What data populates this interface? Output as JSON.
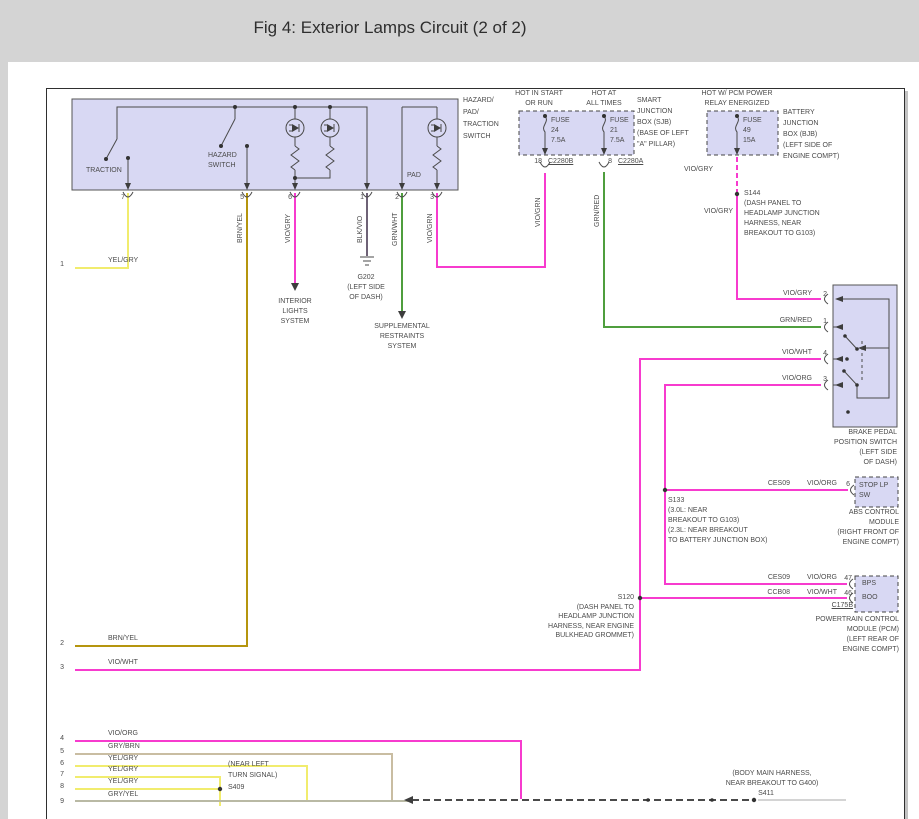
{
  "title": "Fig 4: Exterior Lamps Circuit (2 of 2)",
  "colors": {
    "violet_wire": "#f73bce",
    "green_wire": "#4f9e3e",
    "yellow_wire": "#f1ec6e",
    "brown_yellow_wire": "#b5950e",
    "tan_wire": "#c9bda2",
    "grey_yellow_wire": "#b9b9a4",
    "black_violet_wire": "#6e6276",
    "diagram_ink": "#4a4a4a",
    "component_fill": "#d8d8f3",
    "chrome_grey": "#d4d4d4",
    "panel_white": "#ffffff"
  },
  "diagram": {
    "labels": [
      {
        "n": "switch-traction-label",
        "t": "TRACTION",
        "x": 86,
        "y": 167
      },
      {
        "n": "switch-hazard-label-1",
        "t": "HAZARD",
        "x": 208,
        "y": 152
      },
      {
        "n": "switch-hazard-label-2",
        "t": "SWITCH",
        "x": 208,
        "y": 162
      },
      {
        "n": "switch-pad-label",
        "t": "PAD",
        "x": 407,
        "y": 172
      },
      {
        "n": "switch-name-1",
        "t": "HAZARD/",
        "x": 463,
        "y": 97
      },
      {
        "n": "switch-name-2",
        "t": "PAD/",
        "x": 463,
        "y": 109
      },
      {
        "n": "switch-name-3",
        "t": "TRACTION",
        "x": 463,
        "y": 121
      },
      {
        "n": "switch-name-4",
        "t": "SWITCH",
        "x": 463,
        "y": 133
      },
      {
        "n": "switch-pin-7",
        "t": "7",
        "x": 125,
        "y": 194,
        "a": "r"
      },
      {
        "n": "switch-pin-5",
        "t": "5",
        "x": 244,
        "y": 194,
        "a": "r"
      },
      {
        "n": "switch-pin-6",
        "t": "6",
        "x": 292,
        "y": 194,
        "a": "r"
      },
      {
        "n": "switch-pin-1",
        "t": "1",
        "x": 364,
        "y": 194,
        "a": "r"
      },
      {
        "n": "switch-pin-2",
        "t": "2",
        "x": 399,
        "y": 194,
        "a": "r"
      },
      {
        "n": "switch-pin-3",
        "t": "3",
        "x": 434,
        "y": 194,
        "a": "r"
      },
      {
        "n": "wire-brnyel-vert",
        "t": "BRN/YEL",
        "x": 237,
        "y": 243,
        "r": 1
      },
      {
        "n": "wire-viogry-vert",
        "t": "VIO/GRY",
        "x": 285,
        "y": 243,
        "r": 1
      },
      {
        "n": "wire-blkvio-vert",
        "t": "BLK/VIO",
        "x": 357,
        "y": 243,
        "r": 1
      },
      {
        "n": "wire-grnwht-vert",
        "t": "GRN/WHT",
        "x": 392,
        "y": 246,
        "r": 1
      },
      {
        "n": "wire-viogrn-vert-1",
        "t": "VIO/GRN",
        "x": 427,
        "y": 243,
        "r": 1
      },
      {
        "n": "wire-viogrn-vert-2",
        "t": "VIO/GRN",
        "x": 535,
        "y": 227,
        "r": 1
      },
      {
        "n": "wire-grnred-vert",
        "t": "GRN/RED",
        "x": 594,
        "y": 227,
        "r": 1
      },
      {
        "n": "power-label-1a",
        "t": "HOT IN START",
        "x": 539,
        "y": 90,
        "a": "c"
      },
      {
        "n": "power-label-1b",
        "t": "OR RUN",
        "x": 539,
        "y": 100,
        "a": "c"
      },
      {
        "n": "power-label-2a",
        "t": "HOT AT",
        "x": 604,
        "y": 90,
        "a": "c"
      },
      {
        "n": "power-label-2b",
        "t": "ALL TIMES",
        "x": 604,
        "y": 100,
        "a": "c"
      },
      {
        "n": "power-label-3a",
        "t": "HOT W/ PCM POWER",
        "x": 737,
        "y": 90,
        "a": "c"
      },
      {
        "n": "power-label-3b",
        "t": "RELAY ENERGIZED",
        "x": 737,
        "y": 100,
        "a": "c"
      },
      {
        "n": "fuse24-line1",
        "t": "FUSE",
        "x": 551,
        "y": 117
      },
      {
        "n": "fuse24-line2",
        "t": "24",
        "x": 551,
        "y": 127
      },
      {
        "n": "fuse24-line3",
        "t": "7.5A",
        "x": 551,
        "y": 137
      },
      {
        "n": "fuse21-line1",
        "t": "FUSE",
        "x": 610,
        "y": 117
      },
      {
        "n": "fuse21-line2",
        "t": "21",
        "x": 610,
        "y": 127
      },
      {
        "n": "fuse21-line3",
        "t": "7.5A",
        "x": 610,
        "y": 137
      },
      {
        "n": "fuse49-line1",
        "t": "FUSE",
        "x": 743,
        "y": 117
      },
      {
        "n": "fuse49-line2",
        "t": "49",
        "x": 743,
        "y": 127
      },
      {
        "n": "fuse49-line3",
        "t": "15A",
        "x": 743,
        "y": 137
      },
      {
        "n": "sjb-name-1",
        "t": "SMART",
        "x": 637,
        "y": 97
      },
      {
        "n": "sjb-name-2",
        "t": "JUNCTION",
        "x": 637,
        "y": 108
      },
      {
        "n": "sjb-name-3",
        "t": "BOX (SJB)",
        "x": 637,
        "y": 119
      },
      {
        "n": "sjb-name-4",
        "t": "(BASE OF LEFT",
        "x": 637,
        "y": 130
      },
      {
        "n": "sjb-name-5",
        "t": "\"A\" PILLAR)",
        "x": 637,
        "y": 141
      },
      {
        "n": "bjb-name-1",
        "t": "BATTERY",
        "x": 783,
        "y": 109
      },
      {
        "n": "bjb-name-2",
        "t": "JUNCTION",
        "x": 783,
        "y": 120
      },
      {
        "n": "bjb-name-3",
        "t": "BOX (BJB)",
        "x": 783,
        "y": 131
      },
      {
        "n": "bjb-name-4",
        "t": "(LEFT SIDE OF",
        "x": 783,
        "y": 142
      },
      {
        "n": "bjb-name-5",
        "t": "ENGINE COMPT)",
        "x": 783,
        "y": 153
      },
      {
        "n": "conn-pin-18",
        "t": "18",
        "x": 542,
        "y": 158,
        "a": "r"
      },
      {
        "n": "conn-c2280b",
        "t": "C2280B",
        "x": 548,
        "y": 158,
        "u": 1
      },
      {
        "n": "conn-pin-8",
        "t": "8",
        "x": 612,
        "y": 158,
        "a": "r"
      },
      {
        "n": "conn-c2280a",
        "t": "C2280A",
        "x": 618,
        "y": 158,
        "u": 1
      },
      {
        "n": "wire-viogry-bjb",
        "t": "VIO/GRY",
        "x": 684,
        "y": 166
      },
      {
        "n": "s144-label",
        "t": "S144",
        "x": 744,
        "y": 190
      },
      {
        "n": "s144-note-1",
        "t": "(DASH PANEL TO",
        "x": 744,
        "y": 200
      },
      {
        "n": "s144-note-2",
        "t": "HEADLAMP JUNCTION",
        "x": 744,
        "y": 210
      },
      {
        "n": "s144-note-3",
        "t": "HARNESS, NEAR",
        "x": 744,
        "y": 220
      },
      {
        "n": "s144-note-4",
        "t": "BREAKOUT TO G103)",
        "x": 744,
        "y": 230
      },
      {
        "n": "wire-viogry-2",
        "t": "VIO/GRY",
        "x": 704,
        "y": 208
      },
      {
        "n": "bps-pin2-color",
        "t": "VIO/GRY",
        "x": 812,
        "y": 290,
        "a": "r"
      },
      {
        "n": "bps-pin2-num",
        "t": "2",
        "x": 827,
        "y": 291,
        "a": "r"
      },
      {
        "n": "bps-pin1-color",
        "t": "GRN/RED",
        "x": 812,
        "y": 317,
        "a": "r"
      },
      {
        "n": "bps-pin1-num",
        "t": "1",
        "x": 827,
        "y": 318,
        "a": "r"
      },
      {
        "n": "bps-pin4-color",
        "t": "VIO/WHT",
        "x": 812,
        "y": 349,
        "a": "r"
      },
      {
        "n": "bps-pin4-num",
        "t": "4",
        "x": 827,
        "y": 350,
        "a": "r"
      },
      {
        "n": "bps-pin3-color",
        "t": "VIO/ORG",
        "x": 812,
        "y": 375,
        "a": "r"
      },
      {
        "n": "bps-pin3-num",
        "t": "3",
        "x": 827,
        "y": 376,
        "a": "r"
      },
      {
        "n": "bps-name-1",
        "t": "BRAKE PEDAL",
        "x": 897,
        "y": 429,
        "a": "r"
      },
      {
        "n": "bps-name-2",
        "t": "POSITION SWITCH",
        "x": 897,
        "y": 439,
        "a": "r"
      },
      {
        "n": "bps-name-3",
        "t": "(LEFT SIDE",
        "x": 897,
        "y": 449,
        "a": "r"
      },
      {
        "n": "bps-name-4",
        "t": "OF DASH)",
        "x": 897,
        "y": 459,
        "a": "r"
      },
      {
        "n": "abs-circuit-id",
        "t": "CES09",
        "x": 790,
        "y": 480,
        "a": "r"
      },
      {
        "n": "abs-wire-color",
        "t": "VIO/ORG",
        "x": 837,
        "y": 480,
        "a": "r"
      },
      {
        "n": "abs-pin6-num",
        "t": "6",
        "x": 850,
        "y": 481,
        "a": "r"
      },
      {
        "n": "stoplp-label-1",
        "t": "STOP LP",
        "x": 859,
        "y": 482
      },
      {
        "n": "stoplp-label-2",
        "t": "SW",
        "x": 859,
        "y": 492
      },
      {
        "n": "abs-name-1",
        "t": "ABS CONTROL",
        "x": 899,
        "y": 509,
        "a": "r"
      },
      {
        "n": "abs-name-2",
        "t": "MODULE",
        "x": 899,
        "y": 519,
        "a": "r"
      },
      {
        "n": "abs-name-3",
        "t": "(RIGHT FRONT OF",
        "x": 899,
        "y": 529,
        "a": "r"
      },
      {
        "n": "abs-name-4",
        "t": "ENGINE COMPT)",
        "x": 899,
        "y": 539,
        "a": "r"
      },
      {
        "n": "s133-label",
        "t": "S133",
        "x": 668,
        "y": 497
      },
      {
        "n": "s133-note-1",
        "t": "(3.0L: NEAR",
        "x": 668,
        "y": 507
      },
      {
        "n": "s133-note-2",
        "t": "BREAKOUT TO G103)",
        "x": 668,
        "y": 517
      },
      {
        "n": "s133-note-3",
        "t": "(2.3L: NEAR BREAKOUT",
        "x": 668,
        "y": 527
      },
      {
        "n": "s133-note-4",
        "t": "TO BATTERY JUNCTION BOX)",
        "x": 668,
        "y": 537
      },
      {
        "n": "pcm-row1-circuit",
        "t": "CES09",
        "x": 790,
        "y": 574,
        "a": "r"
      },
      {
        "n": "pcm-row1-color",
        "t": "VIO/ORG",
        "x": 837,
        "y": 574,
        "a": "r"
      },
      {
        "n": "pcm-pin47-num",
        "t": "47",
        "x": 852,
        "y": 575,
        "a": "r"
      },
      {
        "n": "pcm-row2-circuit",
        "t": "CCB08",
        "x": 790,
        "y": 589,
        "a": "r"
      },
      {
        "n": "pcm-row2-color",
        "t": "VIO/WHT",
        "x": 837,
        "y": 589,
        "a": "r"
      },
      {
        "n": "pcm-pin46-num",
        "t": "46",
        "x": 852,
        "y": 590,
        "a": "r"
      },
      {
        "n": "pcm-bps-label",
        "t": "BPS",
        "x": 862,
        "y": 580
      },
      {
        "n": "pcm-boo-label",
        "t": "BOO",
        "x": 862,
        "y": 594
      },
      {
        "n": "pcm-c175b",
        "t": "C175B",
        "x": 853,
        "y": 602,
        "a": "r",
        "u": 1
      },
      {
        "n": "pcm-name-1",
        "t": "POWERTRAIN CONTROL",
        "x": 899,
        "y": 616,
        "a": "r"
      },
      {
        "n": "pcm-name-2",
        "t": "MODULE (PCM)",
        "x": 899,
        "y": 626,
        "a": "r"
      },
      {
        "n": "pcm-name-3",
        "t": "(LEFT REAR OF",
        "x": 899,
        "y": 636,
        "a": "r"
      },
      {
        "n": "pcm-name-4",
        "t": "ENGINE COMPT)",
        "x": 899,
        "y": 646,
        "a": "r"
      },
      {
        "n": "s120-label",
        "t": "S120",
        "x": 634,
        "y": 594,
        "a": "r"
      },
      {
        "n": "s120-note-1",
        "t": "(DASH PANEL TO",
        "x": 634,
        "y": 604,
        "a": "r"
      },
      {
        "n": "s120-note-2",
        "t": "HEADLAMP JUNCTION",
        "x": 634,
        "y": 613,
        "a": "r"
      },
      {
        "n": "s120-note-3",
        "t": "HARNESS, NEAR ENGINE",
        "x": 634,
        "y": 623,
        "a": "r"
      },
      {
        "n": "s120-note-4",
        "t": "BULKHEAD GROMMET)",
        "x": 634,
        "y": 632,
        "a": "r"
      },
      {
        "n": "interior-lights-1",
        "t": "INTERIOR",
        "x": 295,
        "y": 298,
        "a": "c"
      },
      {
        "n": "interior-lights-2",
        "t": "LIGHTS",
        "x": 295,
        "y": 308,
        "a": "c"
      },
      {
        "n": "interior-lights-3",
        "t": "SYSTEM",
        "x": 295,
        "y": 318,
        "a": "c"
      },
      {
        "n": "g202-label",
        "t": "G202",
        "x": 366,
        "y": 274,
        "a": "c"
      },
      {
        "n": "g202-note-1",
        "t": "(LEFT SIDE",
        "x": 366,
        "y": 284,
        "a": "c"
      },
      {
        "n": "g202-note-2",
        "t": "OF DASH)",
        "x": 366,
        "y": 294,
        "a": "c"
      },
      {
        "n": "srs-label-1",
        "t": "SUPPLEMENTAL",
        "x": 402,
        "y": 323,
        "a": "c"
      },
      {
        "n": "srs-label-2",
        "t": "RESTRAINTS",
        "x": 402,
        "y": 333,
        "a": "c"
      },
      {
        "n": "srs-label-3",
        "t": "SYSTEM",
        "x": 402,
        "y": 343,
        "a": "c"
      },
      {
        "n": "wire1-num",
        "t": "1",
        "x": 64,
        "y": 261,
        "a": "r"
      },
      {
        "n": "wire1-color",
        "t": "YEL/GRY",
        "x": 108,
        "y": 257
      },
      {
        "n": "wire2-num",
        "t": "2",
        "x": 64,
        "y": 640,
        "a": "r"
      },
      {
        "n": "wire2-color",
        "t": "BRN/YEL",
        "x": 108,
        "y": 635
      },
      {
        "n": "wire3-num",
        "t": "3",
        "x": 64,
        "y": 664,
        "a": "r"
      },
      {
        "n": "wire3-color",
        "t": "VIO/WHT",
        "x": 108,
        "y": 659
      },
      {
        "n": "wire4-num",
        "t": "4",
        "x": 64,
        "y": 735,
        "a": "r"
      },
      {
        "n": "wire4-color",
        "t": "VIO/ORG",
        "x": 108,
        "y": 730
      },
      {
        "n": "wire5-num",
        "t": "5",
        "x": 64,
        "y": 748,
        "a": "r"
      },
      {
        "n": "wire5-color",
        "t": "GRY/BRN",
        "x": 108,
        "y": 743
      },
      {
        "n": "wire6-num",
        "t": "6",
        "x": 64,
        "y": 760,
        "a": "r"
      },
      {
        "n": "wire6-color",
        "t": "YEL/GRY",
        "x": 108,
        "y": 755
      },
      {
        "n": "wire7-num",
        "t": "7",
        "x": 64,
        "y": 771,
        "a": "r"
      },
      {
        "n": "wire7-color",
        "t": "YEL/GRY",
        "x": 108,
        "y": 766
      },
      {
        "n": "wire8-num",
        "t": "8",
        "x": 64,
        "y": 783,
        "a": "r"
      },
      {
        "n": "wire8-color",
        "t": "YEL/GRY",
        "x": 108,
        "y": 778
      },
      {
        "n": "wire9-num",
        "t": "9",
        "x": 64,
        "y": 798,
        "a": "r"
      },
      {
        "n": "wire9-color",
        "t": "GRY/YEL",
        "x": 108,
        "y": 791
      },
      {
        "n": "s409-note-1",
        "t": "(NEAR LEFT",
        "x": 228,
        "y": 761
      },
      {
        "n": "s409-note-2",
        "t": "TURN SIGNAL)",
        "x": 228,
        "y": 772
      },
      {
        "n": "s409-label",
        "t": "S409",
        "x": 228,
        "y": 784
      },
      {
        "n": "s411-note-1",
        "t": "(BODY MAIN HARNESS,",
        "x": 772,
        "y": 770,
        "a": "c"
      },
      {
        "n": "s411-note-2",
        "t": "NEAR BREAKOUT TO G400)",
        "x": 772,
        "y": 780,
        "a": "c"
      },
      {
        "n": "s411-label",
        "t": "S411",
        "x": 766,
        "y": 790,
        "a": "c"
      }
    ]
  }
}
